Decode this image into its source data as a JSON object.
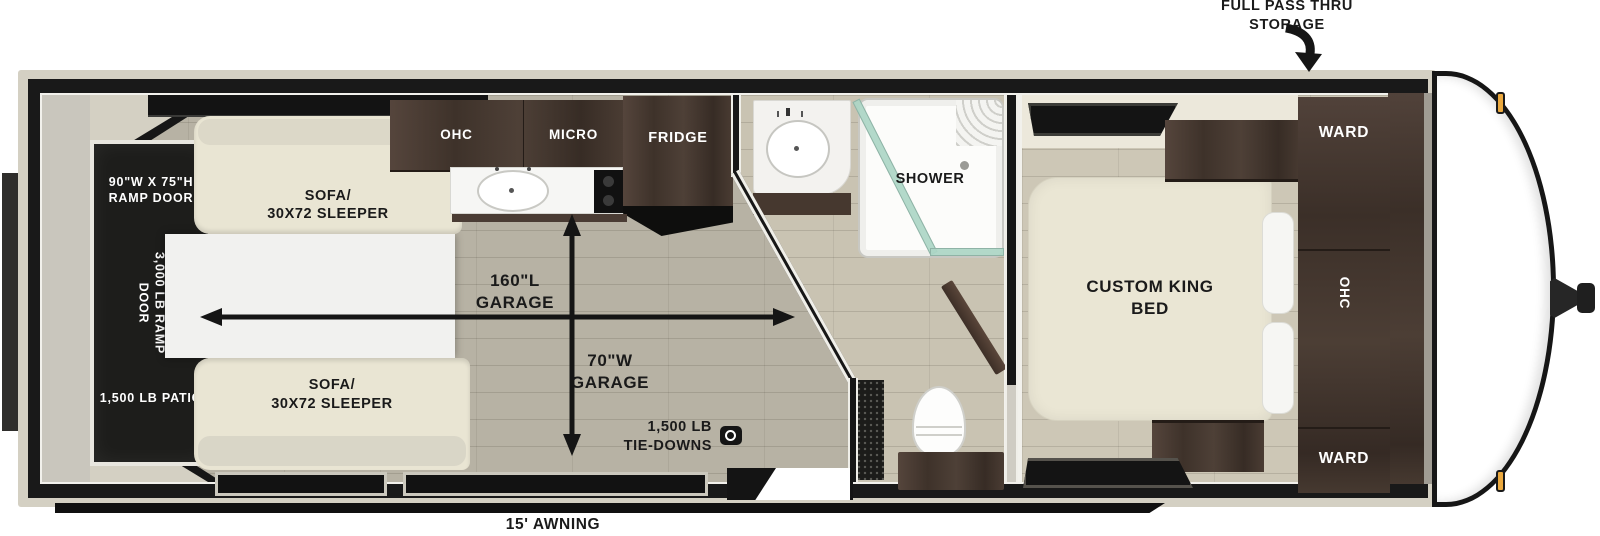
{
  "title": "Toy hauler travel trailer floorplan",
  "colors": {
    "wall_black": "#191919",
    "body_trim": "#d4d0c3",
    "garage_floor": "#b7b2a4",
    "living_floor": "#cdc7b6",
    "cabinet_wood": "#4a3c34",
    "sofa_cream": "#e9e5d3",
    "shower_glass": "#aed6c6",
    "marker_light_amber": "#eba93f"
  },
  "exterior": {
    "pass_thru_l1": "FULL PASS THRU",
    "pass_thru_l2": "STORAGE",
    "awning": "15' AWNING"
  },
  "ramp": {
    "size_l1": "90\"W X 75\"H",
    "size_l2": "RAMP DOOR",
    "capacity_l1": "3,000 LB RAMP",
    "capacity_l2": "DOOR",
    "patio": "1,500 LB PATIO"
  },
  "garage": {
    "sofa_top_l1": "SOFA/",
    "sofa_top_l2": "30X72 SLEEPER",
    "sofa_bottom_l1": "SOFA/",
    "sofa_bottom_l2": "30X72 SLEEPER",
    "length_l1": "160\"L",
    "length_l2": "GARAGE",
    "width_l1": "70\"W",
    "width_l2": "GARAGE",
    "tiedowns_l1": "1,500 LB",
    "tiedowns_l2": "TIE-DOWNS"
  },
  "kitchen": {
    "ohc": "OHC",
    "micro": "MICRO",
    "fridge": "FRIDGE"
  },
  "bath": {
    "shower": "SHOWER"
  },
  "bedroom": {
    "bed_l1": "CUSTOM KING",
    "bed_l2": "BED",
    "ward_top": "WARD",
    "ohc": "OHC",
    "ward_bottom": "WARD"
  }
}
